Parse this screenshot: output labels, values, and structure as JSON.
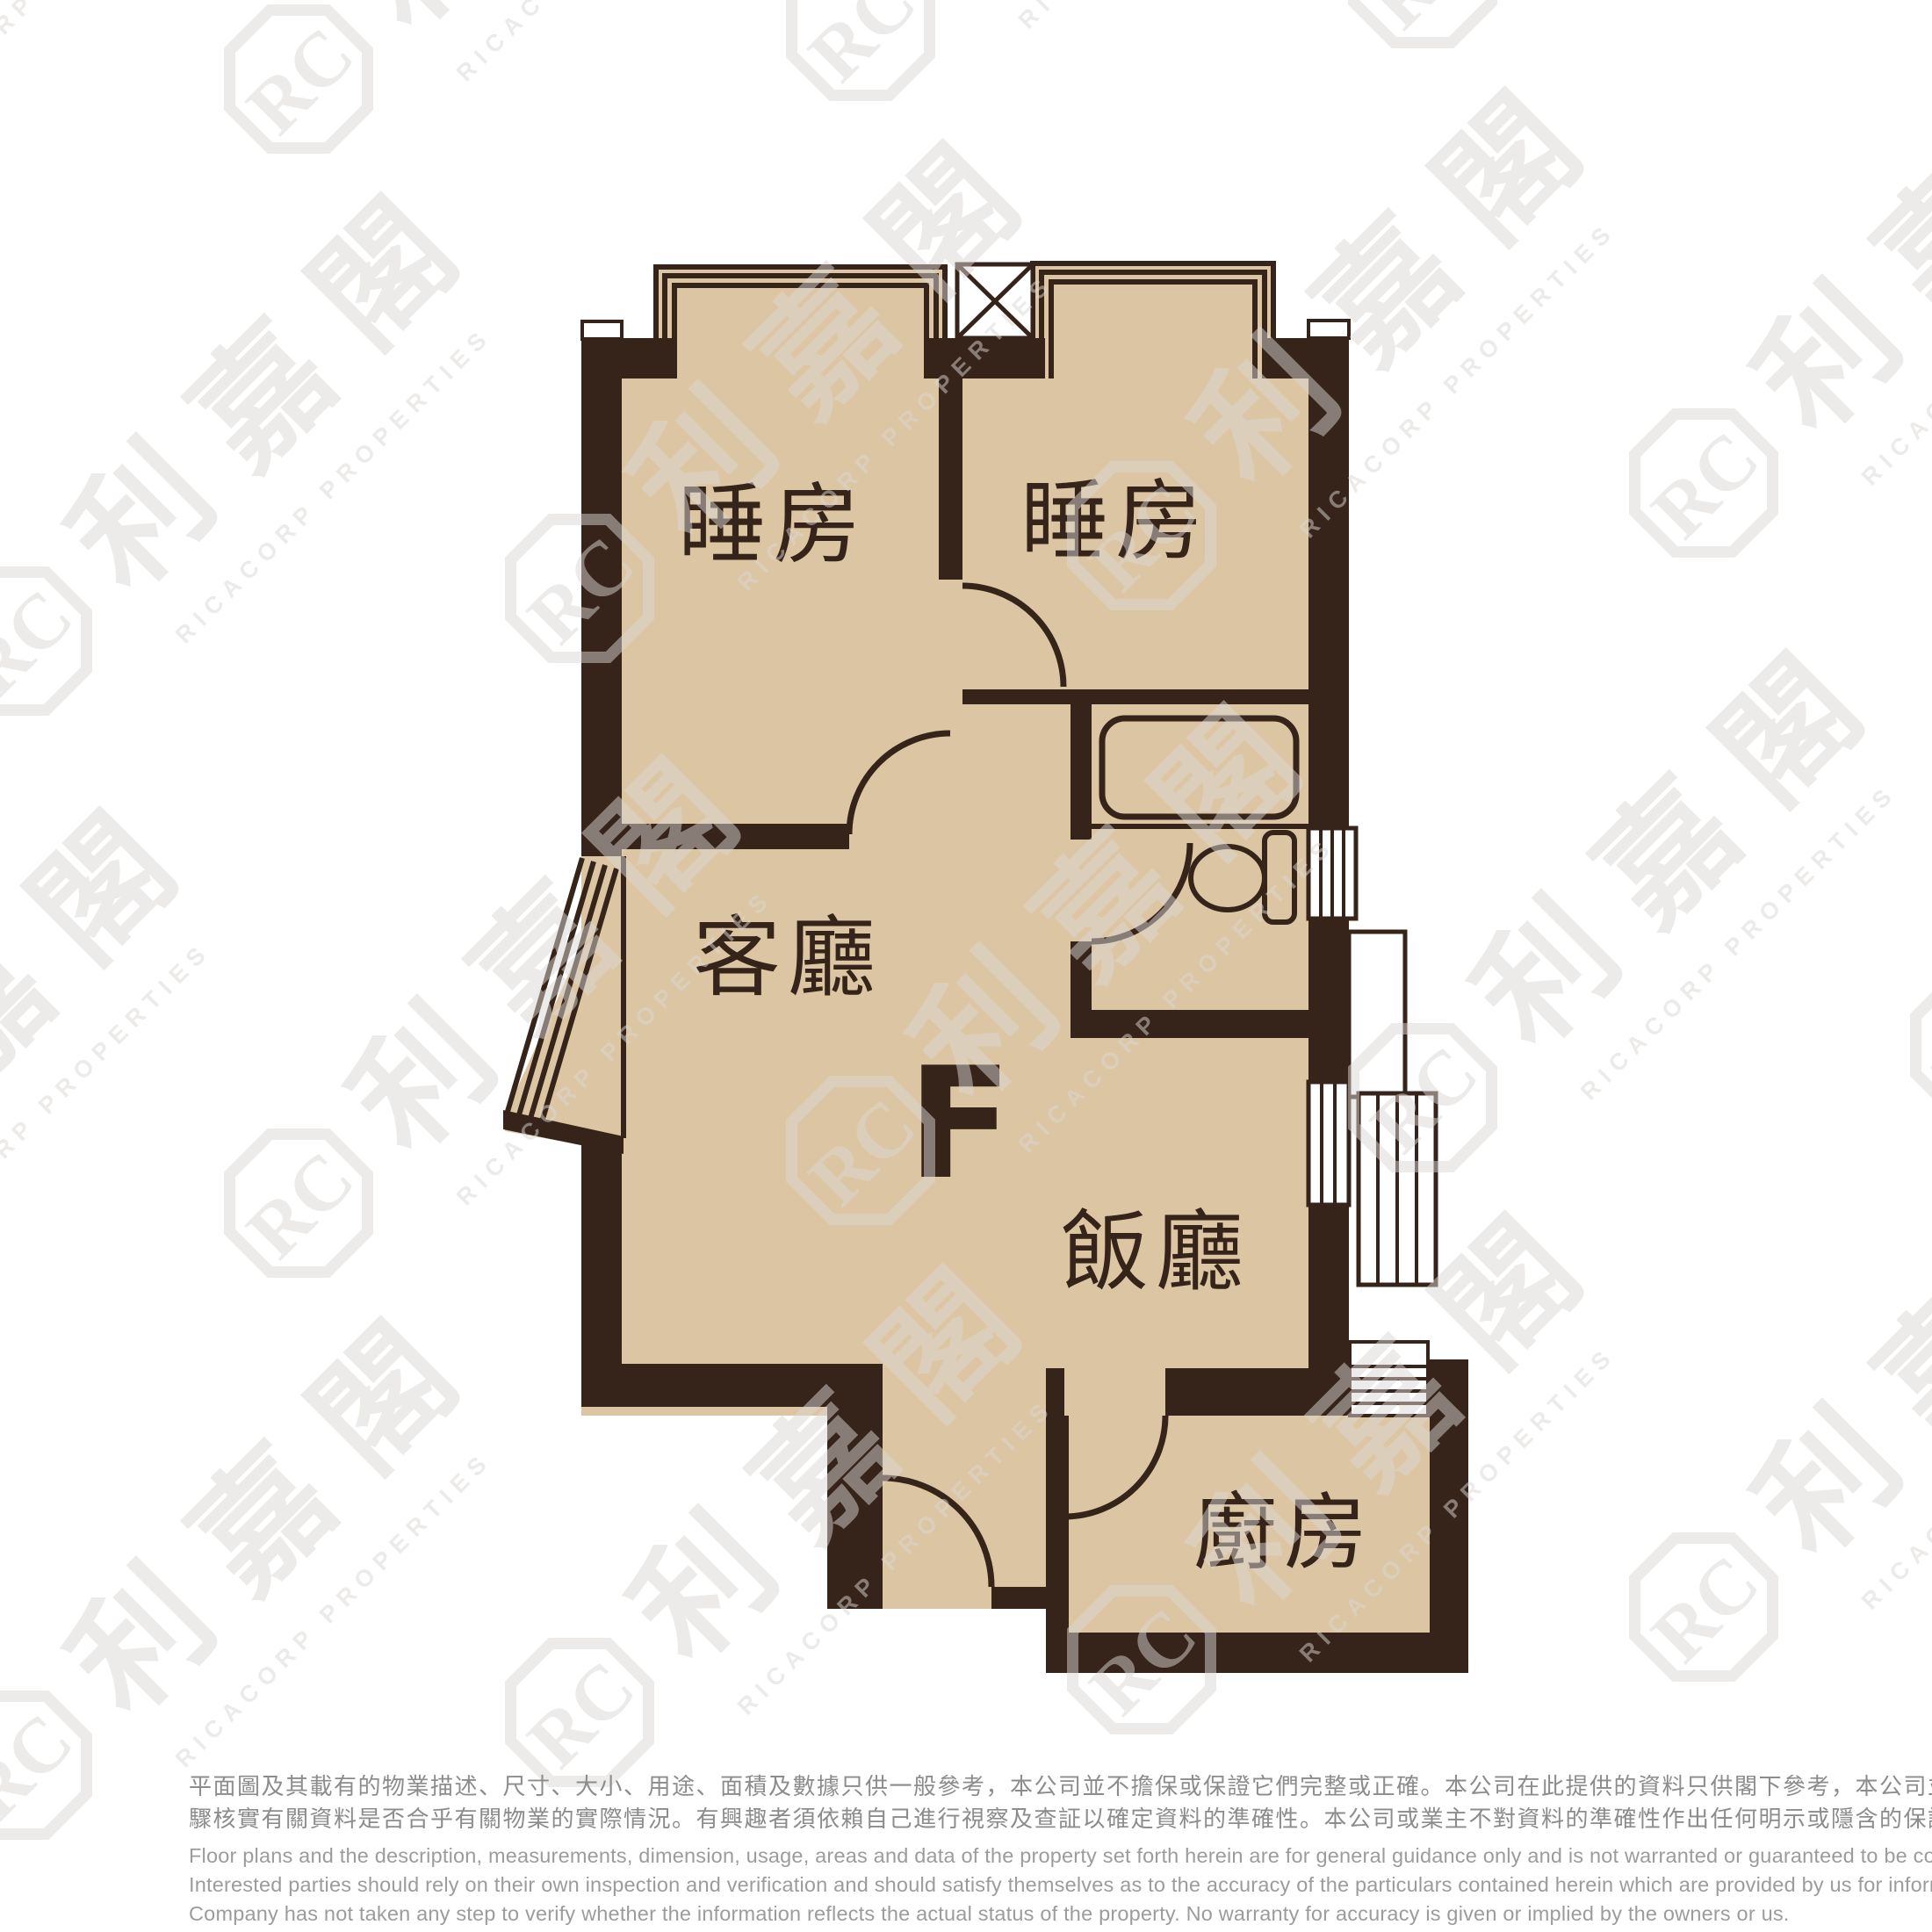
{
  "floor_plan": {
    "unit_label": "F",
    "rooms": {
      "bedroom1": "睡房",
      "bedroom2": "睡房",
      "living_room": "客廳",
      "dining_room": "飯廳",
      "kitchen": "廚房"
    },
    "colors": {
      "floor_fill": "#dcc5a2",
      "wall": "#36241a",
      "fixture_line": "#36241a",
      "watermark": "#dbd7d3",
      "disclaimer_cn": "#8c8c8c",
      "disclaimer_en": "#9c9c9c"
    }
  },
  "watermark": {
    "logo_text": "RC",
    "cjk_text": "利嘉閣",
    "en_text": "RICACORP PROPERTIES"
  },
  "disclaimer": {
    "cn_line1": "平面圖及其載有的物業描述、尺寸、大小、用途、面積及數據只供一般參考，本公司並不擔保或保證它們完整或正確。本公司在此提供的資料只供閣下參考，本公司並無採取任何步",
    "cn_line2": "驟核實有關資料是否合乎有關物業的實際情況。有興趣者須依賴自己進行視察及查証以確定資料的準確性。本公司或業主不對資料的準確性作出任何明示或隱含的保證。",
    "en_line1": "Floor plans and the description, measurements, dimension, usage, areas and data of the property set forth herein are for general guidance only and is not warranted or guaranteed to be complete or correct.",
    "en_line2": "Interested parties should rely on their own inspection and verification and should satisfy themselves as to the accuracy of the particulars contained herein which are provided by us for information only.  Our",
    "en_line3": "Company has not taken any step to verify whether the information reflects the actual status of the property.  No warranty for accuracy is given or implied by the owners or us."
  }
}
